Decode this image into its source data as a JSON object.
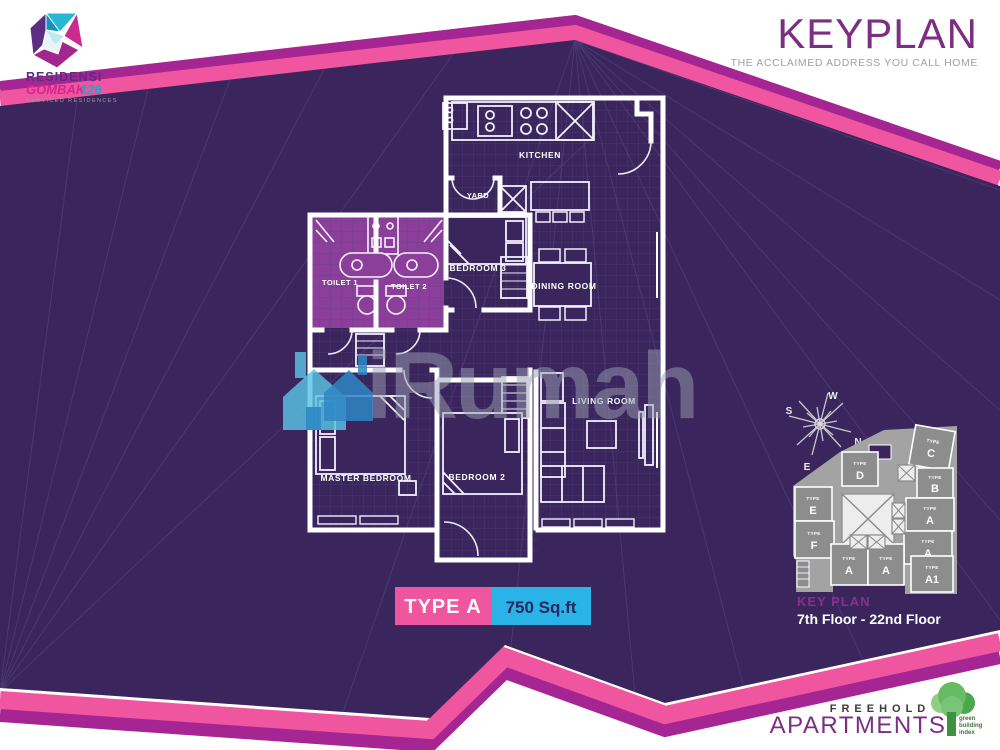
{
  "colors": {
    "background_purple": "#3a265c",
    "pink": "#f0569f",
    "magenta": "#a52693",
    "cyan": "#2ab3e6",
    "toilet_highlight": "#8b3f9a",
    "title_purple": "#7b2e82",
    "keyplan_label_magenta": "#8e2d90",
    "badge_area_text": "#2b2760"
  },
  "header": {
    "logo": {
      "name": "RESIDENSI",
      "name2": "GOMBAK",
      "number": "126",
      "tagline": "SERVICED RESIDENCES"
    },
    "title": "KEYPLAN",
    "subtitle": "THE ACCLAIMED ADDRESS YOU CALL HOME"
  },
  "floorplan": {
    "rooms": {
      "kitchen": "KITCHEN",
      "yard": "YARD",
      "toilet1": "TOILET 1",
      "toilet2": "TOILET 2",
      "bedroom3": "BEDROOM 3",
      "dining": "DINING ROOM",
      "living": "LIVING ROOM",
      "master": "MASTER BEDROOM",
      "bedroom2": "BEDROOM 2"
    }
  },
  "unit_badge": {
    "type": "TYPE A",
    "area": "750 Sq.ft"
  },
  "keyplan_panel": {
    "label": "KEY PLAN",
    "floors": "7th Floor - 22nd Floor",
    "compass": {
      "north": "N",
      "south": "S",
      "east": "E",
      "west": "W"
    },
    "units": [
      {
        "prefix": "TYPE",
        "name": "D"
      },
      {
        "prefix": "TYPE",
        "name": "C"
      },
      {
        "prefix": "TYPE",
        "name": "B"
      },
      {
        "prefix": "TYPE",
        "name": "A",
        "highlighted": true
      },
      {
        "prefix": "TYPE",
        "name": "A",
        "highlighted": true
      },
      {
        "prefix": "TYPE",
        "name": "A1"
      },
      {
        "prefix": "TYPE",
        "name": "E"
      },
      {
        "prefix": "TYPE",
        "name": "F"
      },
      {
        "prefix": "TYPE",
        "name": "A",
        "highlighted": true
      },
      {
        "prefix": "TYPE",
        "name": "A",
        "highlighted": true
      }
    ]
  },
  "watermark": {
    "text": "iRumah"
  },
  "footer": {
    "tenure": "FREEHOLD",
    "type": "APARTMENTS",
    "green_badge": [
      "green",
      "building",
      "index"
    ]
  }
}
